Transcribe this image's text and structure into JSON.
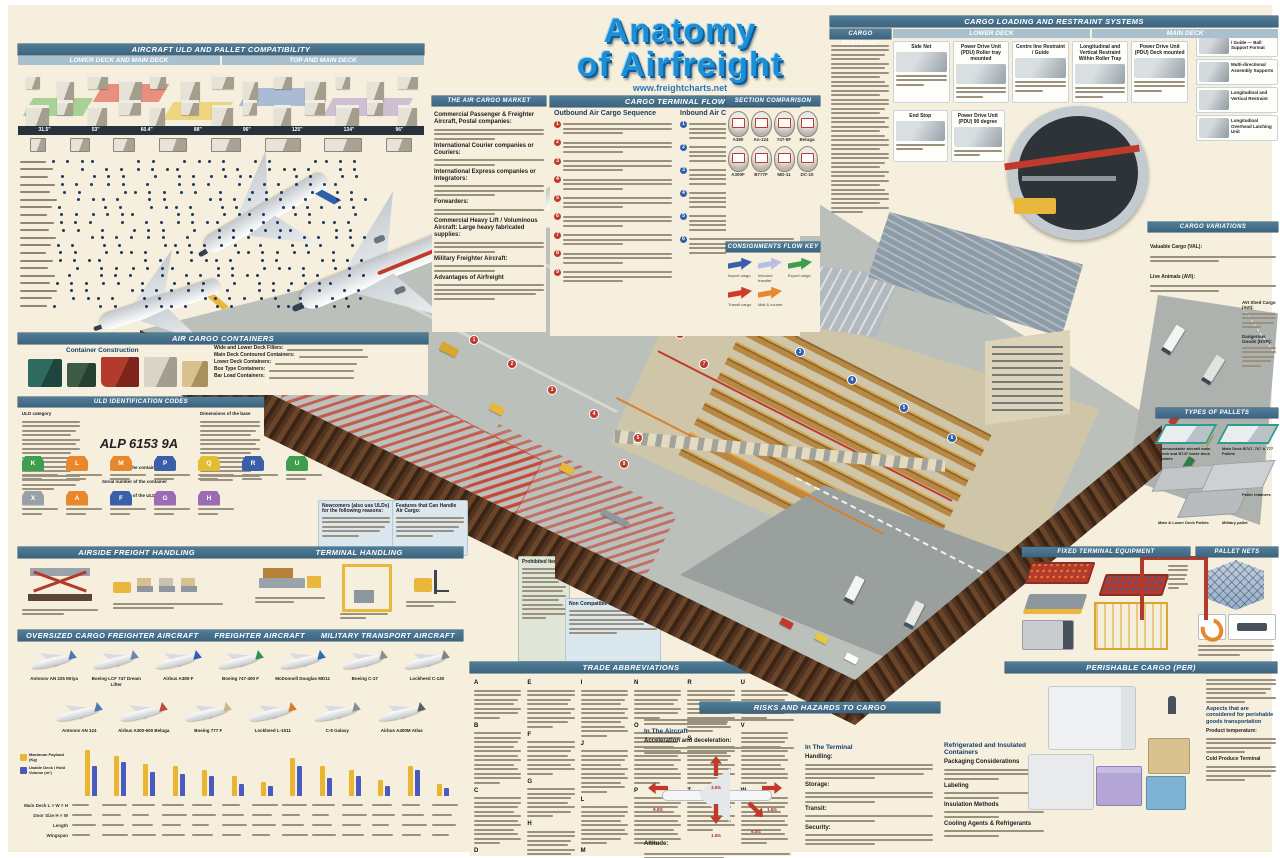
{
  "poster": {
    "title1": "Anatomy",
    "title2": "of Airfreight",
    "website": "www.freightcharts.net"
  },
  "compat": {
    "title": "AIRCRAFT ULD AND PALLET COMPATIBILITY",
    "sub_left": "LOWER DECK AND MAIN DECK",
    "sub_right": "TOP AND MAIN DECK",
    "sizes": [
      "31.5\"",
      "53\"",
      "60.4\"",
      "88\"",
      "96\"",
      "125\"",
      "134\"",
      "96\""
    ]
  },
  "market": {
    "title": "THE AIR CARGO MARKET",
    "terms": [
      "Commercial Passenger & Freighter Aircraft, Postal companies:",
      "International Courier companies or Couriers:",
      "International Express companies or Integrators:",
      "Forwarders:",
      "Commercial Heavy Lift / Voluminous Aircraft: Large heavy fabricated supplies:",
      "Military Freighter Aircraft:",
      "Advantages of Airfreight"
    ]
  },
  "flow": {
    "title": "CARGO TERMINAL FLOW",
    "outbound_heading": "Outbound Air Cargo Sequence",
    "outbound_steps": [
      "1",
      "2",
      "3",
      "4",
      "5",
      "6",
      "7",
      "8",
      "9"
    ],
    "inbound_heading": "Inbound Air Cargo Sequence",
    "inbound_steps": [
      "1",
      "2",
      "3",
      "4",
      "5",
      "6"
    ]
  },
  "comparison": {
    "title": "SECTION COMPARISON",
    "aircraft": [
      "A380",
      "An-124",
      "747-8F",
      "Beluga",
      "A300F",
      "B777F",
      "MD-11",
      "DC-10"
    ]
  },
  "flowkey": {
    "title": "CONSIGNMENTS FLOW KEY",
    "items": [
      {
        "label": "Import cargo",
        "color": "#3a5fa8"
      },
      {
        "label": "Inbound transfer",
        "color": "#b9bfe4"
      },
      {
        "label": "Export cargo",
        "color": "#3f9e4d"
      },
      {
        "label": "Transit cargo",
        "color": "#d03a2a"
      },
      {
        "label": "Mail & courier",
        "color": "#e8872c"
      }
    ]
  },
  "loading": {
    "title": "CARGO LOADING AND RESTRAINT SYSTEMS",
    "restraint_title": "CARGO RESTRAINT",
    "lower_title": "LOWER DECK",
    "main_title": "MAIN DECK",
    "cards_top": [
      "Side Net",
      "Power Drive Unit (PDU) Roller tray mounted",
      "Centre line Restraint / Guide",
      "Longitudinal and Vertical Restraint Within Roller Tray",
      "Power Drive Unit (PDU) Deck mounted"
    ],
    "cards_bottom": [
      "End Stop",
      "Power Drive Unit (PDU) 90 degree"
    ],
    "diagrams": [
      "Centre line Restraint / Guide — Ball Support Format",
      "Multi-directional Assembly Supports",
      "Longitudinal and Vertical Restraint",
      "Longitudinal Overhead Latching Unit"
    ]
  },
  "containers": {
    "title": "AIR CARGO CONTAINERS",
    "construction": "Container Construction",
    "terms": [
      "Wide and Lower Deck Fillers:",
      "Main Deck Contoured Containers:",
      "Lower Deck Containers:",
      "Box Type Containers:",
      "Bar Load Containers:"
    ]
  },
  "uld": {
    "title": "ULD IDENTIFICATION CODES",
    "category_label": "ULD category",
    "dims_label": "Dimensions of the base",
    "code": "ALP 6153 9A",
    "callouts": [
      "Owner of the container",
      "Serial number of the container",
      "Contour of the ULD"
    ],
    "contours": [
      {
        "code": "K",
        "color": "#3f9e4d"
      },
      {
        "code": "L",
        "color": "#e8872c"
      },
      {
        "code": "M",
        "color": "#e8872c"
      },
      {
        "code": "P",
        "color": "#3a5fa8"
      },
      {
        "code": "Q",
        "color": "#e3bd33"
      },
      {
        "code": "R",
        "color": "#3a5fa8"
      },
      {
        "code": "U",
        "color": "#3f9e4d"
      },
      {
        "code": "X",
        "color": "#98a0a8"
      },
      {
        "code": "A",
        "color": "#e8872c"
      },
      {
        "code": "F",
        "color": "#3a5fa8"
      },
      {
        "code": "G",
        "color": "#9b6bb3"
      },
      {
        "code": "H",
        "color": "#9b6bb3"
      }
    ],
    "newcomers_title": "Newcomers (also use ULDs) for the following reasons:",
    "features_title": "Features that Can Handle Air Cargo:"
  },
  "airside": {
    "title": "AIRSIDE FREIGHT HANDLING"
  },
  "thandling": {
    "title": "TERMINAL HANDLING"
  },
  "aircraftpanel": {
    "t1": "OVERSIZED CARGO FREIGHTER AIRCRAFT",
    "t2": "FREIGHTER AIRCRAFT",
    "t3": "MILITARY TRANSPORT AIRCRAFT",
    "row1": [
      {
        "name": "Antonov AN 225 Mriya",
        "tail": "#4a7ab5"
      },
      {
        "name": "Boeing LCF 747 Dream Lifter",
        "tail": "#6a87b8"
      },
      {
        "name": "Airbus A380-F",
        "tail": "#2f5fae"
      },
      {
        "name": "Boeing 747-400 F",
        "tail": "#2f8f5b"
      },
      {
        "name": "McDonnell Douglas MD11",
        "tail": "#2b6fae"
      },
      {
        "name": "Boeing C-17",
        "tail": "#8a8f96"
      },
      {
        "name": "Lockheed C-130",
        "tail": "#7d838a"
      }
    ],
    "row2": [
      {
        "name": "Antonov AN 124",
        "tail": "#4a7ab5"
      },
      {
        "name": "Airbus A300-600 Beluga",
        "tail": "#c04a3e"
      },
      {
        "name": "Boeing 777 F",
        "tail": "#c9b78a"
      },
      {
        "name": "Lockheed L-1011",
        "tail": "#d07b2e"
      },
      {
        "name": "C-5 Galaxy",
        "tail": "#8a8f96"
      },
      {
        "name": "Airbus A400M Atlas",
        "tail": "#5a5f66"
      }
    ],
    "legend": [
      {
        "label": "Maximum Payload (Kg)",
        "color": "#eab632"
      },
      {
        "label": "Usable Deck / Hold Volume (m³)",
        "color": "#4a5bbf"
      }
    ],
    "specs": [
      "Main Deck L × W × H",
      "Door Size H × W",
      "Length",
      "Wingspan"
    ]
  },
  "abbr": {
    "title": "TRADE ABBREVIATIONS",
    "letters": [
      "A",
      "B",
      "C",
      "D",
      "E",
      "F",
      "G",
      "H",
      "I",
      "J",
      "L",
      "M",
      "N",
      "O",
      "P",
      "R",
      "S",
      "T",
      "U",
      "V",
      "W"
    ],
    "noncompat": "Non Compatible Loads:",
    "prohibited": "Prohibited Items"
  },
  "risks": {
    "title": "RISKS AND HAZARDS TO CARGO",
    "in_aircraft": "In The Aircraft",
    "aircraft_terms": [
      "Acceleration and deceleration:",
      "Altitude:",
      "Temperature:"
    ],
    "g_labels": [
      "3.0G",
      "1.5G",
      "9.0G",
      "1.5G",
      "6.0G"
    ],
    "in_terminal": "In The Terminal",
    "terminal_terms": [
      "Handling:",
      "Storage:",
      "Transit:",
      "Security:"
    ]
  },
  "refrig": {
    "heading": "Refrigerated and Insulated Containers",
    "subheads": [
      "Packaging Considerations",
      "Labeling",
      "Insulation Methods",
      "Cooling Agents & Refrigerants"
    ]
  },
  "perishable": {
    "title": "PERISHABLE CARGO (PER)",
    "aspects": "Aspects that are considered for perishable goods transportation",
    "terms": [
      "Product temperature:",
      "Cold Produce Terminal"
    ]
  },
  "variations": {
    "title": "CARGO VARIATIONS",
    "terms": [
      "Valuable Cargo (VAL):",
      "Live Animals (AVI):"
    ],
    "side_terms": [
      "AVI Shed Cargo (AVI):",
      "Dangerous Goods (DGR):"
    ]
  },
  "pallets": {
    "title": "TYPES OF PALLETS",
    "labels": [
      "Demountable aircraft main deck and B747 lower deck pallets",
      "Main Deck B747, 767 & 777 Pallets",
      "Pallet retainers",
      "Main & Lower Deck Pallets",
      "Military pallet"
    ]
  },
  "fixedequip": {
    "title": "FIXED TERMINAL EQUIPMENT"
  },
  "palletnets": {
    "title": "PALLET NETS"
  }
}
